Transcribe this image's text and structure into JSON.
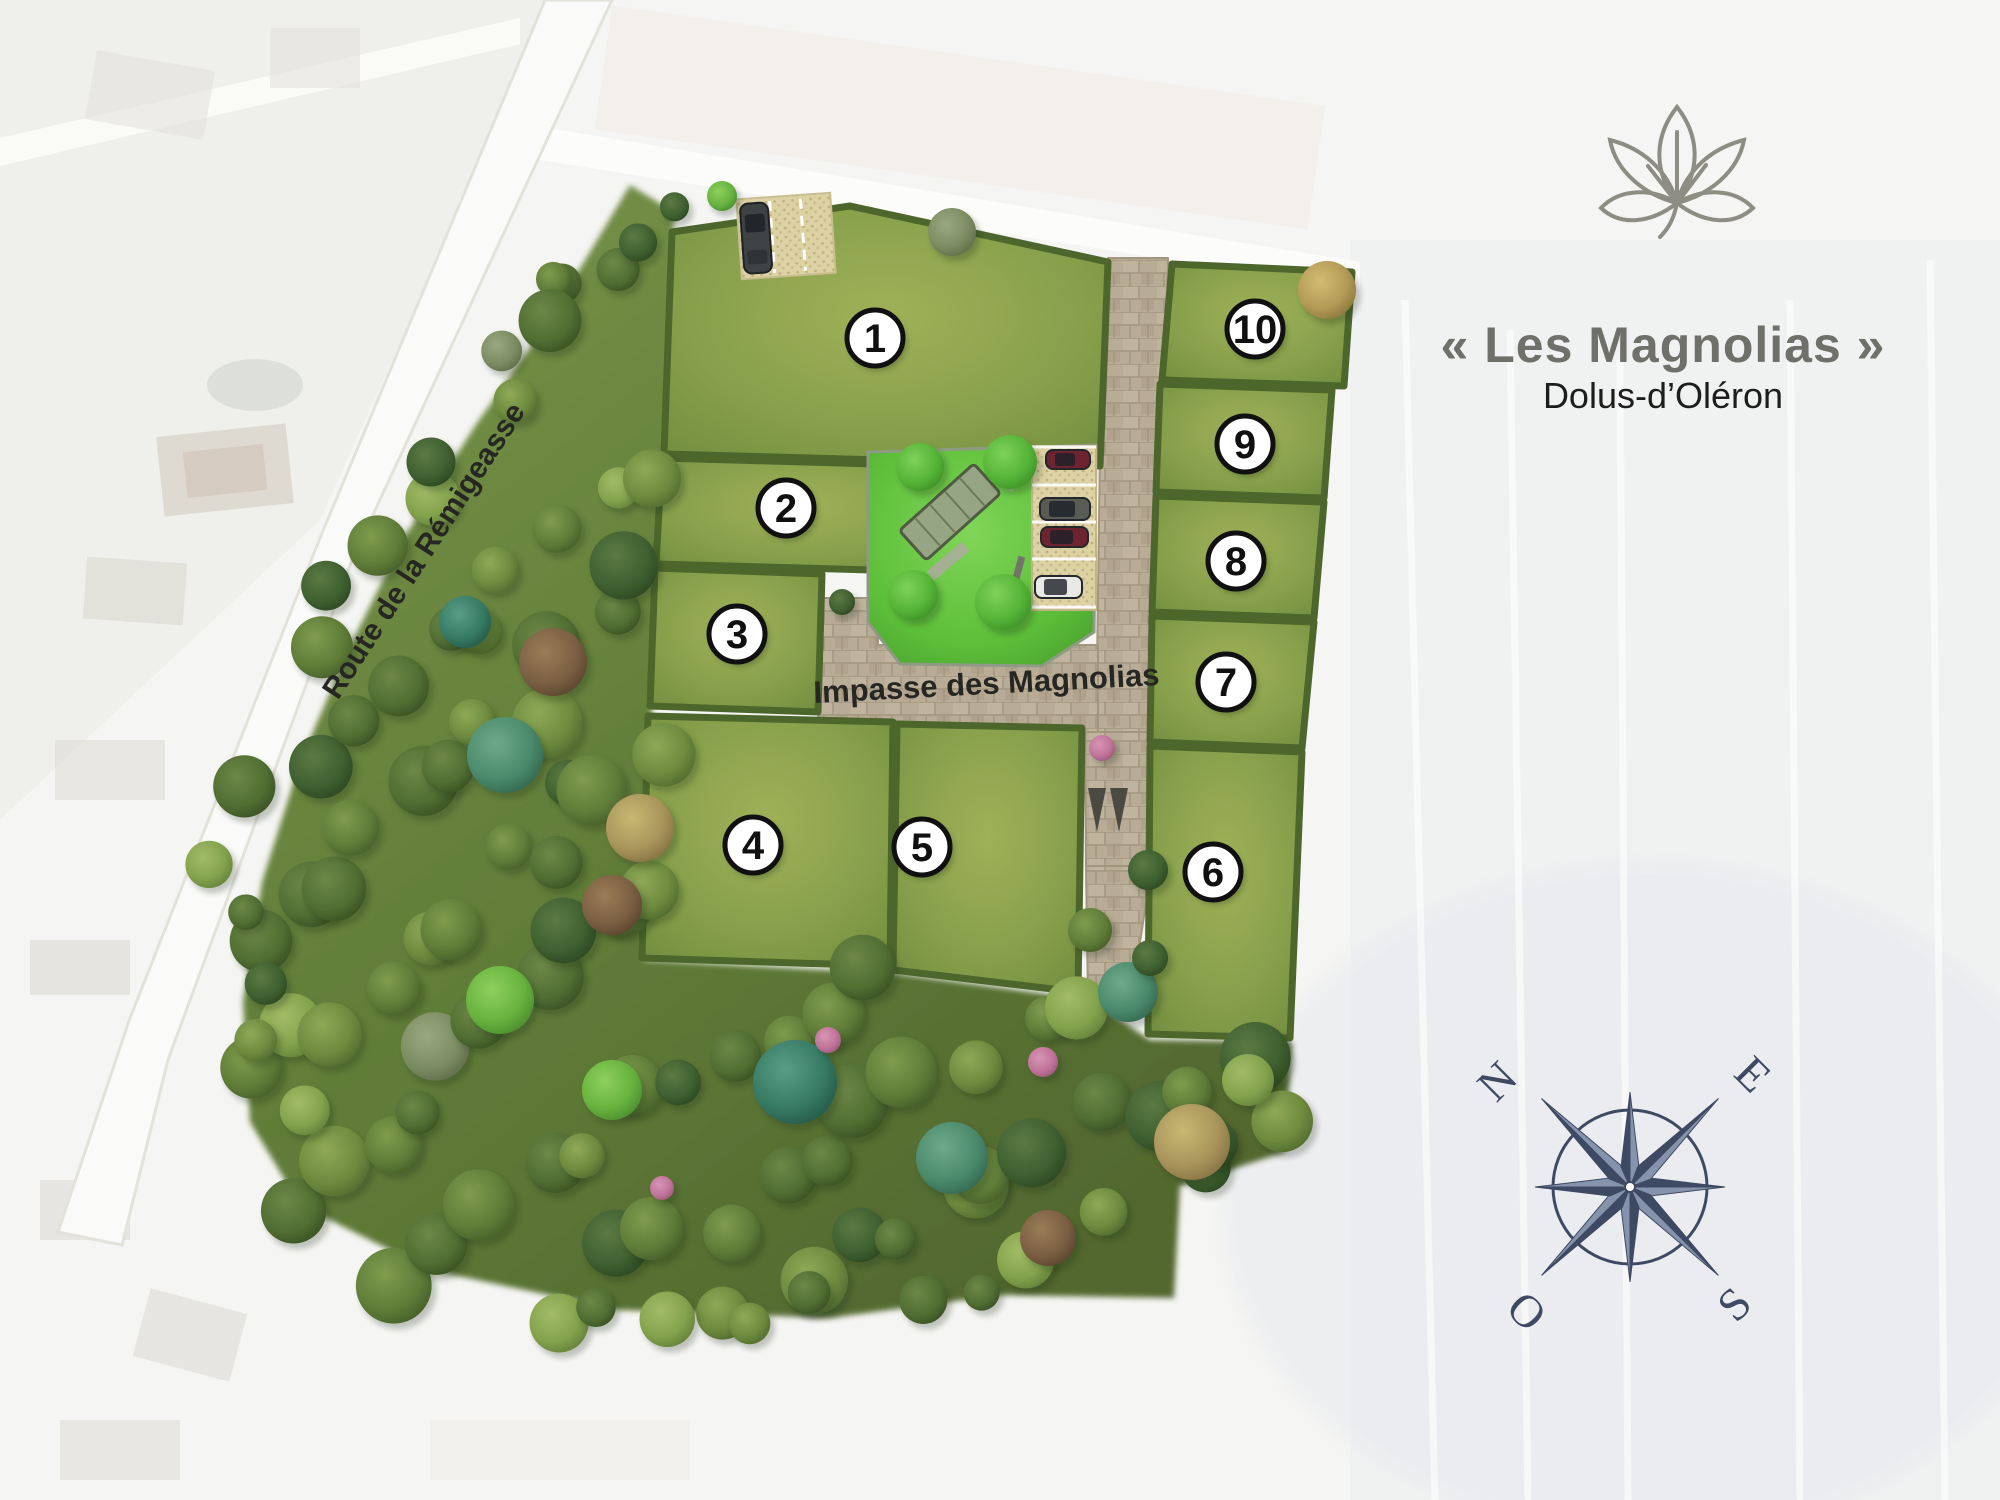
{
  "header": {
    "title": "« Les Magnolias »",
    "subtitle": "Dolus-d’Oléron"
  },
  "plan": {
    "street_label": "Impasse des Magnolias",
    "road_label": "Route de la Rémigeasse",
    "lots": [
      {
        "number": "1",
        "x": 875,
        "y": 338
      },
      {
        "number": "2",
        "x": 786,
        "y": 508
      },
      {
        "number": "3",
        "x": 737,
        "y": 634
      },
      {
        "number": "4",
        "x": 753,
        "y": 845
      },
      {
        "number": "5",
        "x": 922,
        "y": 847
      },
      {
        "number": "6",
        "x": 1213,
        "y": 872
      },
      {
        "number": "7",
        "x": 1226,
        "y": 682
      },
      {
        "number": "8",
        "x": 1236,
        "y": 561
      },
      {
        "number": "9",
        "x": 1245,
        "y": 444
      },
      {
        "number": "10",
        "x": 1255,
        "y": 329
      }
    ],
    "compass": {
      "north": "N",
      "east": "E",
      "south": "S",
      "west": "O"
    },
    "colors": {
      "hedge": "#4d662c",
      "lot_grass": "#8ba24f",
      "square_grass": "#5cbe39",
      "road": "#b7aa95",
      "forest": "#5f7d33",
      "compass": "#3e4a63",
      "title": "#70706a",
      "subtitle": "#1d1d1b",
      "label": "#262622",
      "logo": "#8d8d84"
    }
  }
}
